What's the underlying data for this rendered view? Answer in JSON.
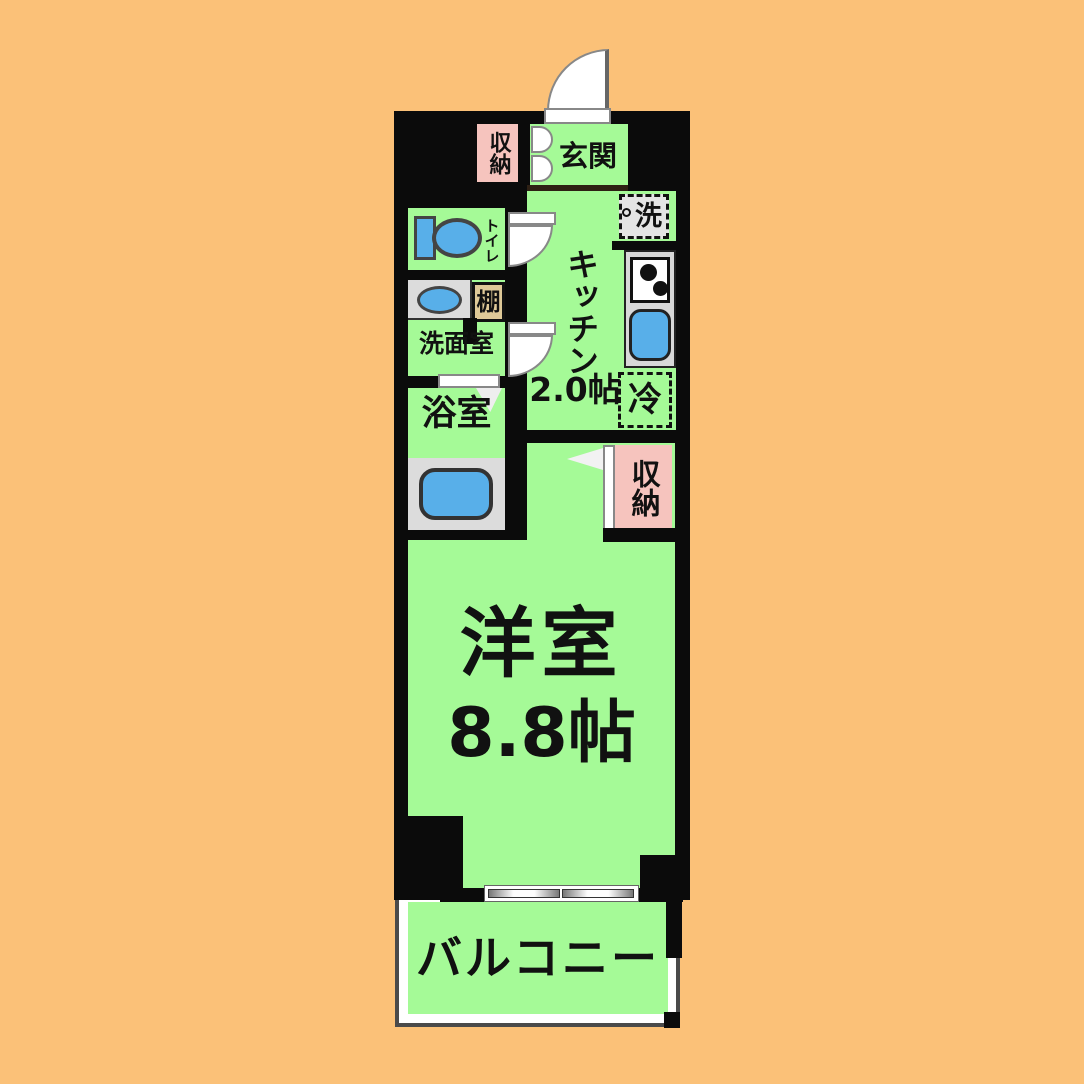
{
  "type": "floor_plan",
  "colors": {
    "bg_orange": "#FBC178",
    "wall_black": "#0b0b0b",
    "room_green": "#A5FA97",
    "closet_pink": "#F6C4BE",
    "fixture_blue": "#58AFE9",
    "counter_gray": "#DCDCDC",
    "shelf_tan": "#DFC998",
    "balcony_gray": "#4a4a4a",
    "door_white": "#ffffff",
    "door_edge": "#888888",
    "step_brown": "#2e2014",
    "ink": "#111111"
  },
  "rooms": {
    "genkan": {
      "label": "玄関"
    },
    "kitchen": {
      "label": "キッチン",
      "size_label": "2.0帖"
    },
    "toilet": {
      "label": "トイレ"
    },
    "washroom": {
      "label": "洗面室"
    },
    "shelf": {
      "label": "棚"
    },
    "bathroom": {
      "label": "浴室"
    },
    "storage_entrance": {
      "label": "収納"
    },
    "storage_main": {
      "label": "収納"
    },
    "washer": {
      "label": "洗"
    },
    "fridge": {
      "label": "冷"
    },
    "main_room": {
      "label": "洋室",
      "size_label": "8.8帖"
    },
    "balcony": {
      "label": "バルコニー"
    }
  }
}
